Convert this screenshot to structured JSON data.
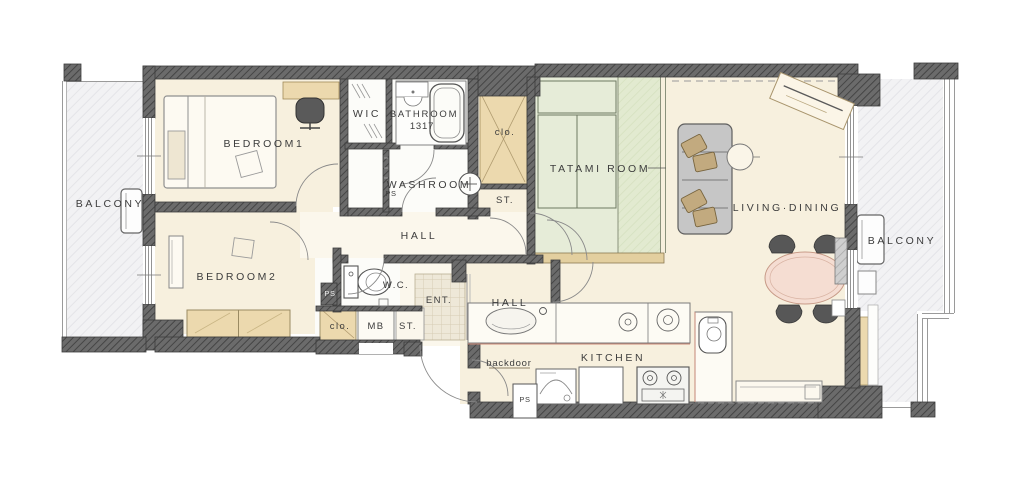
{
  "plan_title": "apartment floor plan",
  "labels": {
    "balcony_left": "BALCONY",
    "bedroom1": "BEDROOM1",
    "wic": "WIC",
    "bathroom": "BATHROOM",
    "bathroom_size": "1317",
    "clo_top": "clo.",
    "tatami_room": "TATAMI ROOM",
    "living_dining": "LIVING·DINING",
    "washroom": "WASHROOM",
    "ps_washroom": "PS",
    "st_top": "ST.",
    "hall": "HALL",
    "bedroom2": "BEDROOM2",
    "wc": "W.C.",
    "ps_wc": "PS",
    "clo_bottom": "clo.",
    "mb": "MB",
    "st_bottom": "ST.",
    "ent": "ENT.",
    "hall_lower": "HALL",
    "backdoor": "backdoor",
    "ps_kitchen": "PS",
    "kitchen": "KITCHEN",
    "balcony_right": "BALCONY"
  },
  "colors": {
    "wall": "#686868",
    "wall_line": "#3c3c3c",
    "floor_cream": "#f7f0de",
    "floor_hall": "#fbf7ec",
    "floor_wet": "#fcfcf9",
    "tan_closet": "#ecd9ae",
    "tatami_green": "#e6ecd8",
    "balcony_gray": "#f2f2f4",
    "table_pink": "#f5ddd2",
    "sofa_gray": "#c6c6c6",
    "cushion_tan": "#c2aa7f",
    "accent_red": "#cc8877"
  }
}
